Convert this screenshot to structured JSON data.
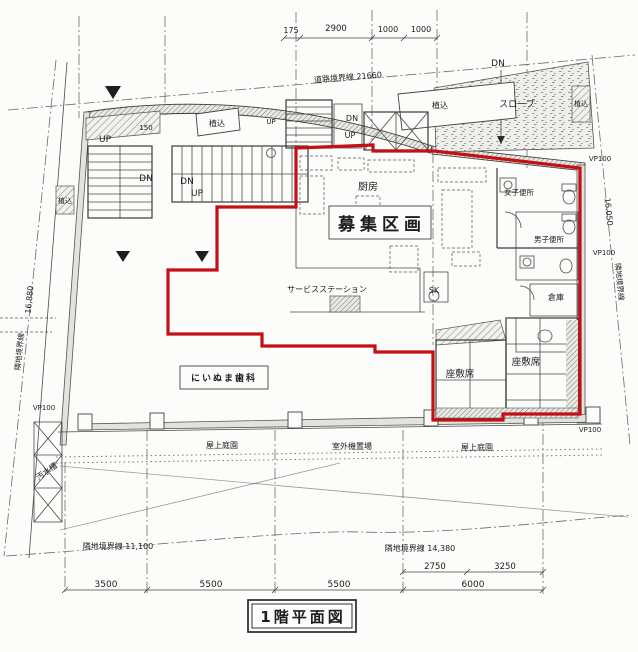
{
  "title": "1階平面図",
  "colors": {
    "lease_red": "#c41014",
    "line": "#3a3a3a"
  },
  "rooms": {
    "kitchen": "厨房",
    "lease_area": "募集区画",
    "dental_clinic": "にいぬま歯科",
    "service_station": "サービスステーション",
    "tatami_left": "座敷席",
    "tatami_right": "座敷席",
    "storage": "倉庫",
    "womens_toilet": "女子便所",
    "mens_toilet": "男子便所",
    "slope": "スロープ",
    "sink_sk": "SK",
    "sewage_tank": "汚水槽",
    "roof_garden_left": "屋上庭園",
    "outdoor_units": "室外機置場",
    "roof_garden_right": "屋上庭園"
  },
  "site": {
    "road_boundary": "道路境界線 21660",
    "left_boundary_label": "隣地境界線",
    "left_boundary_value": "16,880",
    "right_boundary_label": "隣地境界線",
    "right_boundary_value": "16.050",
    "bottom_left_boundary": "隣地境界線 11,100",
    "bottom_right_boundary": "隣地境界線 14,380",
    "planting": "植込",
    "vp100": "VP100"
  },
  "stairs": {
    "up": "UP",
    "down": "DN"
  },
  "dims": {
    "top": [
      "175",
      "2900",
      "1000",
      "1000"
    ],
    "bottom": [
      "3500",
      "5500",
      "5500",
      "6000"
    ],
    "bottom_sub": [
      "2750",
      "3250"
    ],
    "ledge": "150"
  }
}
